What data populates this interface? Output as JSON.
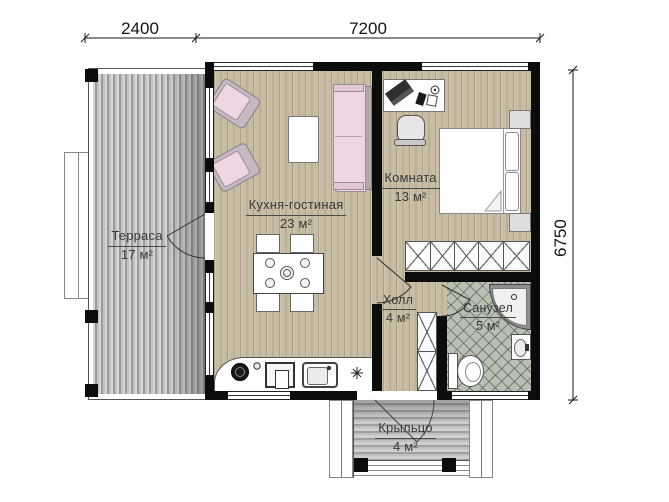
{
  "dimensions": {
    "top_left": "2400",
    "top_right": "7200",
    "right": "6750"
  },
  "rooms": {
    "terrace": {
      "name": "Терраса",
      "area": "17 м²"
    },
    "kitchen_living": {
      "name": "Кухня-гостиная",
      "area": "23 м²"
    },
    "bedroom": {
      "name": "Комната",
      "area": "13 м²"
    },
    "hall": {
      "name": "Холл",
      "area": "4 м²"
    },
    "bathroom": {
      "name": "Санузел",
      "area": "5 м²"
    },
    "porch": {
      "name": "Крыльцо",
      "area": "4 м²"
    }
  },
  "colors": {
    "wall": "#0c0c0c",
    "wood_floor": "#c8bca3",
    "deck": "#b5b5b5",
    "tile": "#b9bfb2",
    "furniture_pink": "#eed7e2",
    "background": "#ffffff",
    "label_text": "#3a3a3a"
  }
}
